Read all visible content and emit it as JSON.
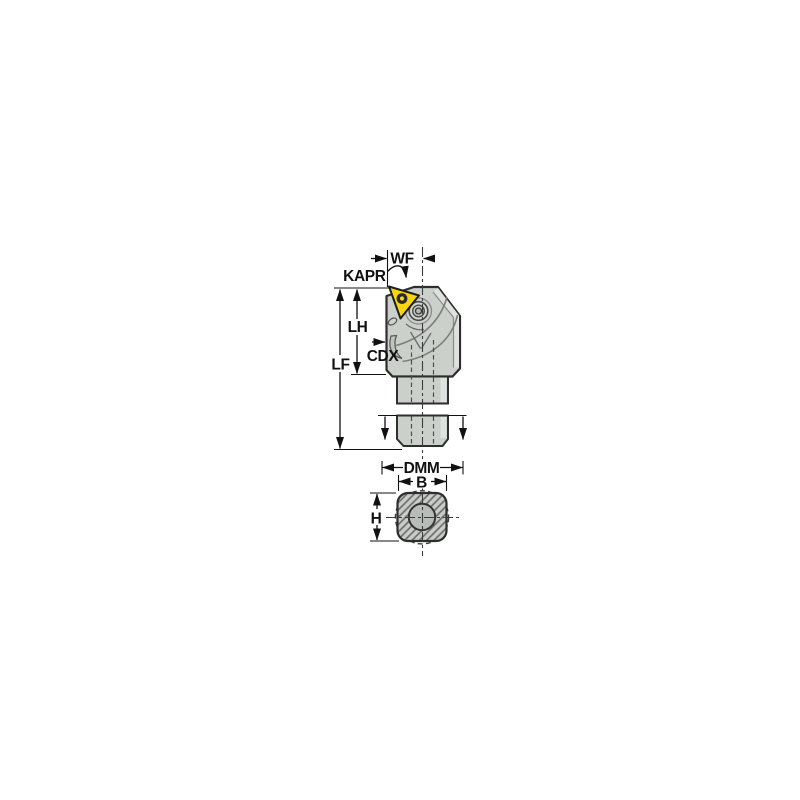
{
  "diagram": {
    "kind": "technical-dimension-drawing",
    "subject": "turning tool holder with triangular insert, side view with broken shank and square shank cross-section",
    "labels": {
      "wf": "WF",
      "kapr": "KAPR",
      "lh": "LH",
      "cdx": "CDX",
      "lf": "LF",
      "dmm": "DMM",
      "b": "B",
      "h": "H"
    },
    "colors": {
      "background": "#ffffff",
      "insert_yellow": "#f6d511",
      "body_gray": "#cbd0cb",
      "body_light_facet": "#dee1de",
      "outline_dark": "#2e2e2e",
      "detail_gray": "#7d7d7d",
      "dimension_black": "#111111",
      "hatch_gray": "#6e6e6e",
      "bore_gray": "#b8bcb8"
    }
  }
}
